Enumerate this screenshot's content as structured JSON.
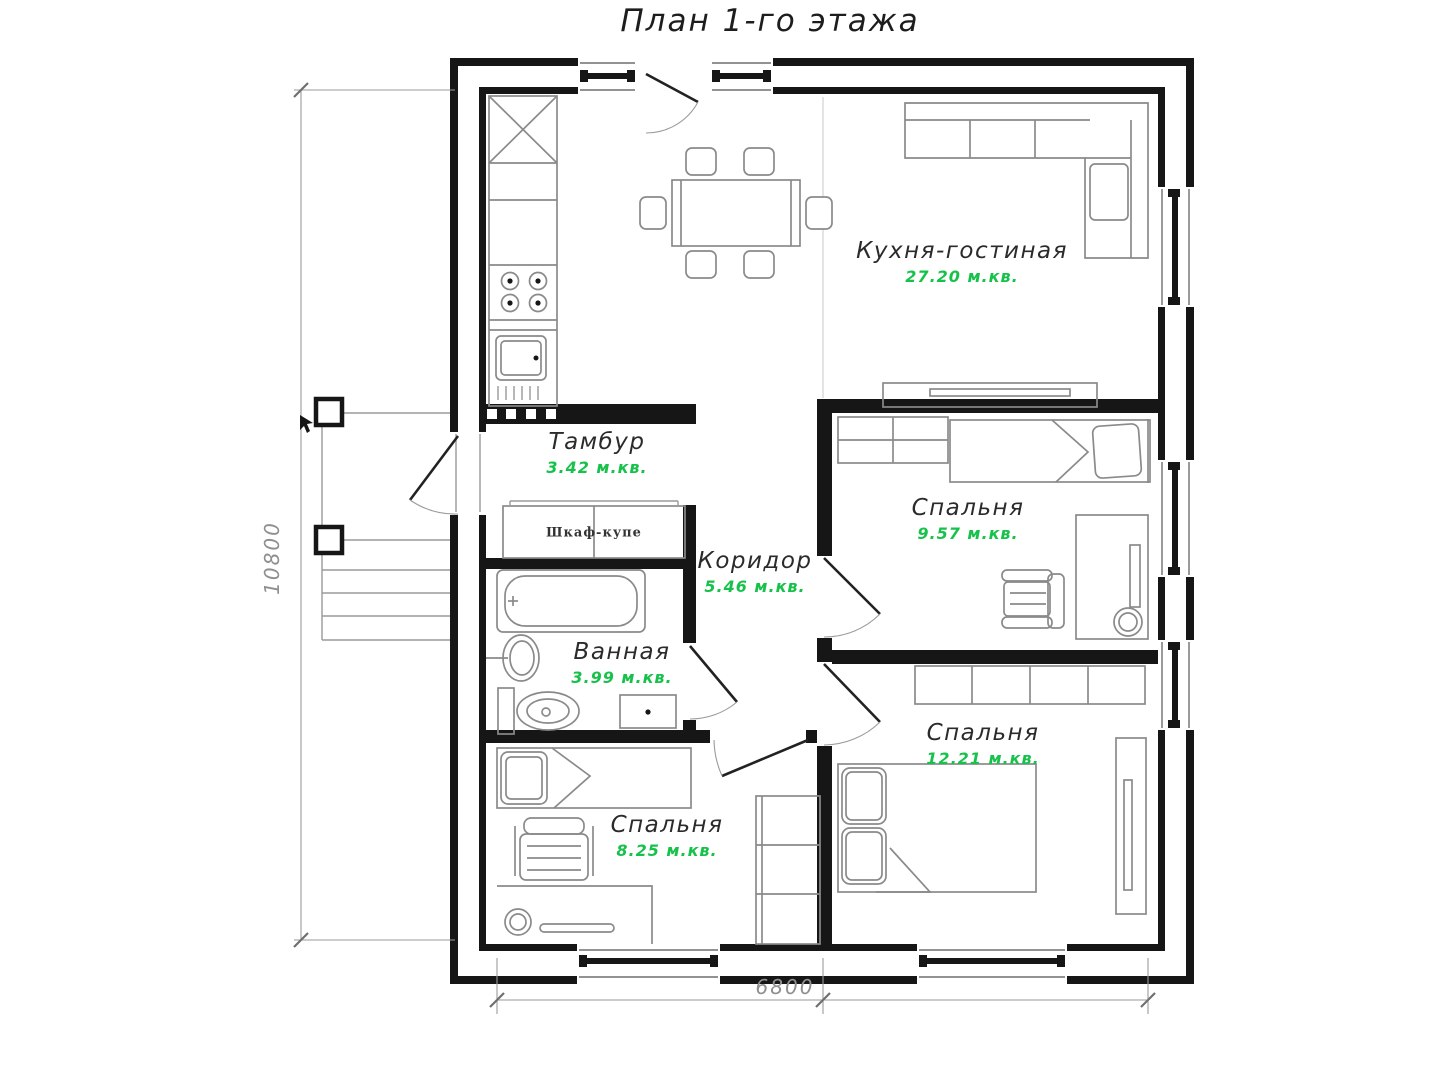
{
  "title": "План 1-го этажа",
  "colors": {
    "area_text": "#17c24b",
    "walls": "#161616"
  },
  "rooms": [
    {
      "name": "Кухня-гостиная",
      "area": "27.20 м.кв."
    },
    {
      "name": "Тамбур",
      "area": "3.42 м.кв."
    },
    {
      "name": "Коридор",
      "area": "5.46 м.кв."
    },
    {
      "name": "Спальня",
      "area": "9.57 м.кв."
    },
    {
      "name": "Ванная",
      "area": "3.99 м.кв."
    },
    {
      "name": "Спальня",
      "area": "12.21 м.кв."
    },
    {
      "name": "Спальня",
      "area": "8.25 м.кв."
    }
  ],
  "labels": {
    "closet": "Шкаф-купе"
  },
  "dimensions": {
    "left_height_mm": "10800",
    "bottom_width_mm": "6800"
  }
}
